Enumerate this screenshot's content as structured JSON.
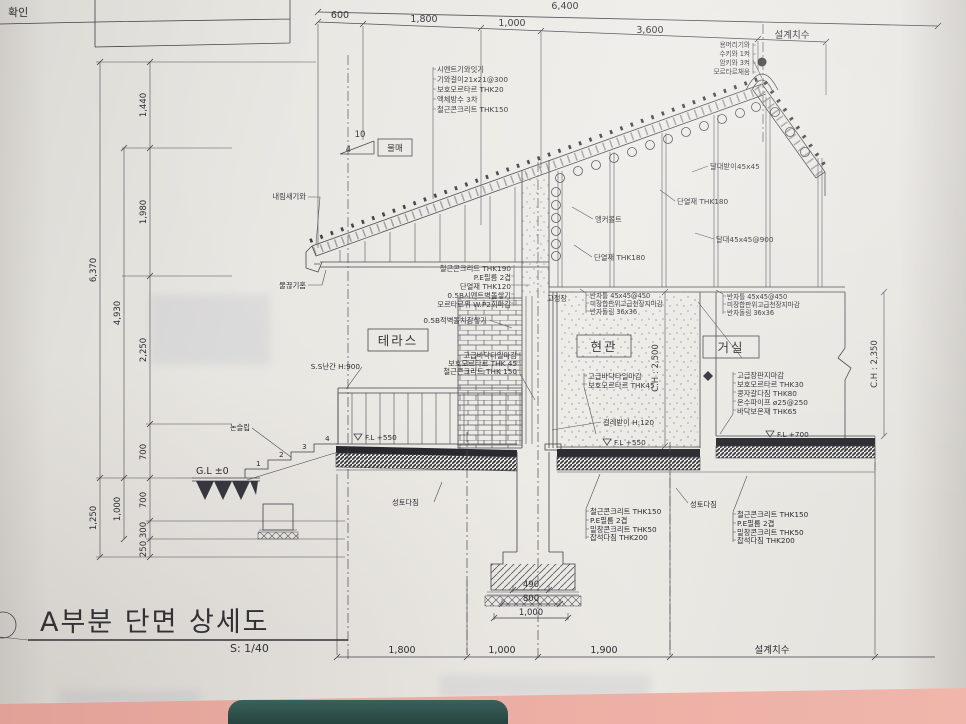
{
  "title": {
    "text": "A부분 단면 상세도",
    "scale": "S: 1/40"
  },
  "titleblock": {
    "confirm": "확인"
  },
  "colors": {
    "paper": "#e8e6e1",
    "line": "#3f3f46",
    "desk_pink": "#eaaca2",
    "desk_object_teal": "#2f534e"
  },
  "rooms": {
    "terrace": "테라스",
    "hall": "현관",
    "living": "거실"
  },
  "slope": {
    "run": "10",
    "rise": "4",
    "label": "물매"
  },
  "dims": {
    "top": {
      "overall": "6,400",
      "s1": "600",
      "s2": "1,800",
      "s3": "1,000",
      "s4": "3,600",
      "design": "설계치수"
    },
    "bottom": {
      "s1": "1,800",
      "s2": "1,000",
      "s3": "1,900",
      "design": "설계치수"
    },
    "left": {
      "a1": "1,440",
      "a2": "1,980",
      "a3": "2,250",
      "a4": "700",
      "b1": "700",
      "b2": "300",
      "b3": "250",
      "m1": "4,930",
      "m2": "1,000",
      "o1": "6,370",
      "o2": "1,250"
    },
    "footing": {
      "d1": "490",
      "d2": "800",
      "d3": "1,000"
    },
    "ch_hall": "C.H : 2,500",
    "ch_living": "C.H : 2,350"
  },
  "levels": {
    "gl": "G.L ±0",
    "fl550": "F.L +550",
    "fl700": "F.L +700"
  },
  "ridge": [
    "용머리기와",
    "수키와 1켜",
    "암키와 3켜",
    "모르타르채움"
  ],
  "roof_layers": [
    "시멘트기와잇기",
    "기와걸이21x21@300",
    "보호모르타르 THK20",
    "액체방수 3차",
    "철근콘크리트 THK150"
  ],
  "eave": {
    "tile": "내림새기와",
    "drip": "물끊기홈"
  },
  "attic": {
    "hanger_support": "달대받이45x45",
    "insul": "단열재 THK180",
    "anchor": "앵커볼트",
    "hanger": "달대45x45@900"
  },
  "wall_layers": [
    "철근콘크리트 THK190",
    "P.E필름 2겹",
    "단열재 THK120",
    "0.5B시멘트벽돌쌓기",
    "모르타르위 W.P2회마감",
    "0.5B적벽돌치장쌓기"
  ],
  "window": "고정창",
  "ceiling_layers": [
    "반자틀 45x45@450",
    "미장합판위고급천장지마감",
    "반자돌림 36x36"
  ],
  "terrace": {
    "railing": "S.S난간 H:900",
    "nonslip": "논슬립",
    "layers": [
      "고급바닥타일마감",
      "보호모르타르 THK 45",
      "철근콘크리트 THK 150"
    ]
  },
  "hall_floor": {
    "layers": [
      "고급바닥타일마감",
      "보호모르타르 THK45"
    ],
    "baseboard": "걸레받이 H:120"
  },
  "living_floor": [
    "고급장판지마감",
    "보호모르타르 THK30",
    "콩자갈다짐 THK80",
    "온수파이프 ø25@250",
    "바닥보온재 THK65"
  ],
  "ground": {
    "fill": "성토다짐"
  },
  "foundation_layers": [
    "철근콘크리트 THK150",
    "P.E필름 2겹",
    "밑창콘크리트 THK50",
    "잡석다짐 THK200"
  ],
  "steps": [
    "1",
    "2",
    "3",
    "4"
  ]
}
